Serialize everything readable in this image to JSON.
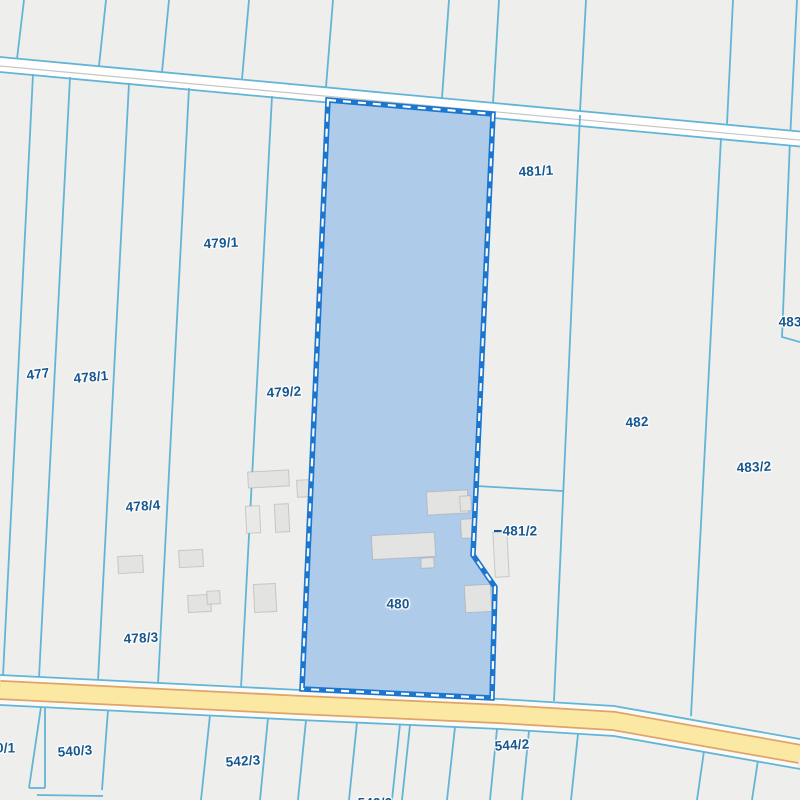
{
  "map": {
    "type": "cadastral-parcel-map",
    "highlighted_parcel": {
      "label": "480"
    },
    "labels": [
      {
        "id": "479-1",
        "text": "479/1"
      },
      {
        "id": "481-1",
        "text": "481/1"
      },
      {
        "id": "477",
        "text": "477"
      },
      {
        "id": "478-1",
        "text": "478/1"
      },
      {
        "id": "479-2",
        "text": "479/2"
      },
      {
        "id": "482",
        "text": "482"
      },
      {
        "id": "483-1",
        "text": "483/1"
      },
      {
        "id": "483-2",
        "text": "483/2"
      },
      {
        "id": "478-4",
        "text": "478/4"
      },
      {
        "id": "481-2",
        "text": "481/2"
      },
      {
        "id": "480",
        "text": "480"
      },
      {
        "id": "478-3",
        "text": "478/3"
      },
      {
        "id": "540-1",
        "text": "540/1"
      },
      {
        "id": "540-3",
        "text": "540/3"
      },
      {
        "id": "542-3",
        "text": "542/3"
      },
      {
        "id": "544-2",
        "text": "544/2"
      },
      {
        "id": "542-2",
        "text": "542/2"
      }
    ],
    "colors": {
      "background": "#eeeeec",
      "parcel_line": "#62b5d6",
      "highlight_fill": "#aecbe9",
      "highlight_border": "#1b76d0",
      "highlight_dash": "#ffffff",
      "label_text": "#17578f",
      "building_fill": "#e3e3e2",
      "main_road_fill": "#fbe8a3",
      "main_road_casing": "#dfa469",
      "minor_road_fill": "#ffffff",
      "minor_road_casing": "#c6c6c4"
    }
  }
}
